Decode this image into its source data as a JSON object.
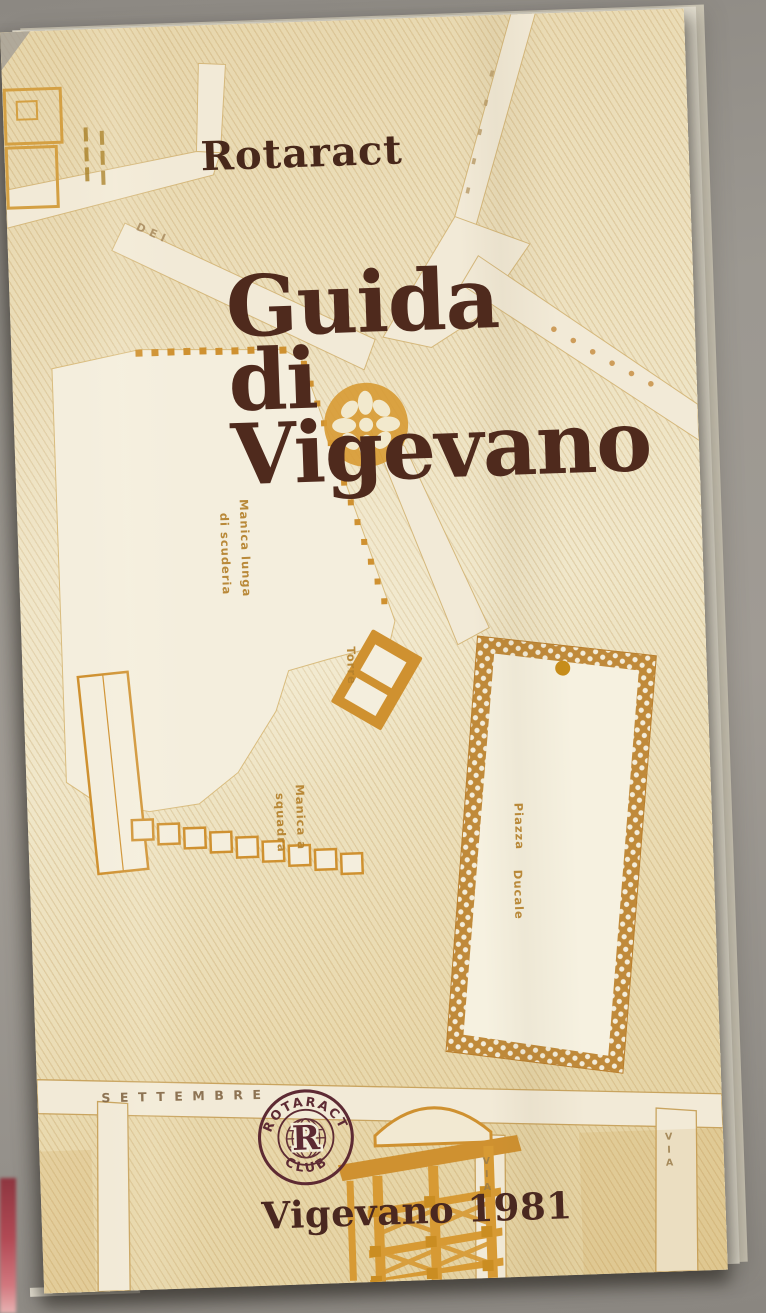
{
  "cover": {
    "publisher": "Rotaract",
    "title": [
      "Guida",
      "di",
      "Vigevano"
    ],
    "imprint": "Vigevano 1981"
  },
  "logo": {
    "arc_top": "ROTARACT",
    "arc_bottom": "CLUB",
    "monogram": "R"
  },
  "map": {
    "labels": {
      "manica_lunga_line1": "Manica lunga",
      "manica_lunga_line2": "di scuderia",
      "torre": "Torre",
      "manica_squadra_line1": "Manica a",
      "manica_squadra_line2": "squadra",
      "piazza_line1": "Piazza",
      "piazza_line2": "Ducale",
      "street_settembre": "SETTEMBRE",
      "street_dei": "DEI",
      "street_via_right": "VIA",
      "street_via_center": "VIA"
    }
  },
  "colors": {
    "background_gray": "#98948e",
    "paper_cream": "#ecdfba",
    "street_light": "#f2ead7",
    "map_ink_orange": "#d0952f",
    "label_orange": "#b5812c",
    "title_brown": "#4f2a1d",
    "logo_maroon": "#5d2a33",
    "red_object": "#b24a55"
  }
}
